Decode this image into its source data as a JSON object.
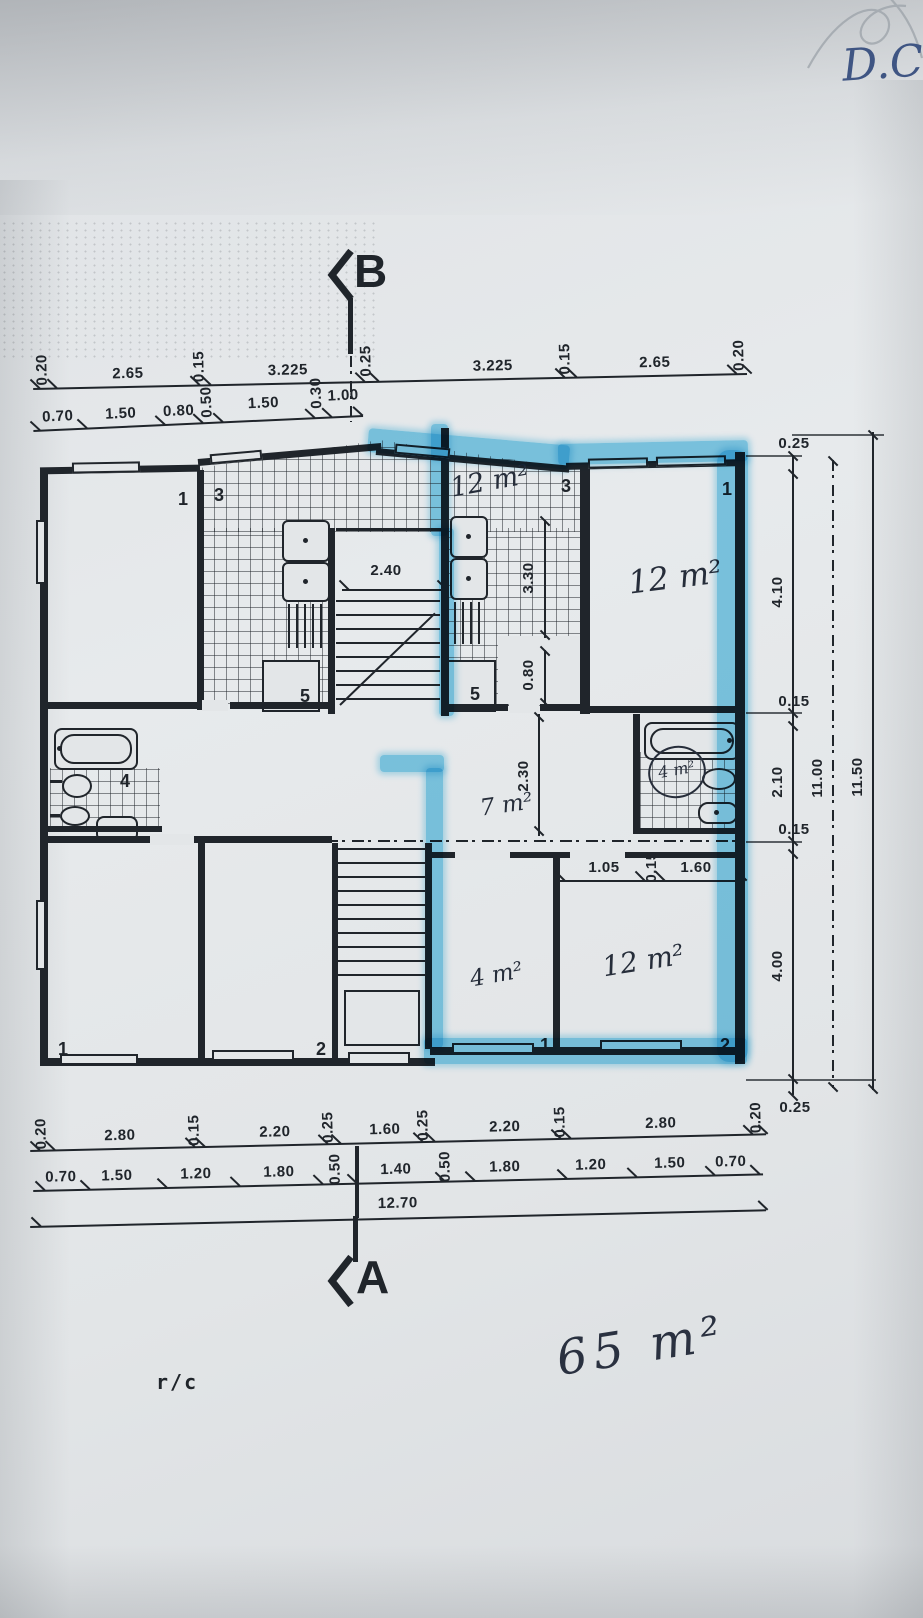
{
  "page": {
    "bg": "#e3e6e8",
    "ink": "#20252b",
    "highlight": "#56c0e8",
    "pen_blue": "#3f5583"
  },
  "header": {
    "handwriting": "D.C"
  },
  "section_markers": {
    "top": "B",
    "bottom": "A"
  },
  "dims": {
    "top_row1": [
      "0.20",
      "2.65",
      "0.15",
      "3.225",
      "0.25",
      "3.225",
      "0.15",
      "2.65",
      "0.20"
    ],
    "top_row2": [
      "0.70",
      "1.50",
      "0.80",
      "0.50",
      "1.50",
      "0.30",
      "1.00"
    ],
    "right_chain": [
      "0.25",
      "4.10",
      "0.15",
      "2.10",
      "0.15",
      "4.00",
      "0.25"
    ],
    "right_total": "11.00",
    "right_overall": "11.50",
    "bottom_row1": [
      "0.20",
      "2.80",
      "0.15",
      "2.20",
      "0.25",
      "1.60",
      "0.25",
      "2.20",
      "0.15",
      "2.80",
      "0.20"
    ],
    "bottom_row2": [
      "0.70",
      "1.50",
      "1.20",
      "1.80",
      "0.50",
      "1.40",
      "0.50",
      "1.80",
      "1.20",
      "1.50",
      "0.70"
    ],
    "bottom_total": "12.70",
    "interior": {
      "stair_width": "2.40",
      "kitchen_depth": "3.30",
      "door": "0.80",
      "hall_depth": "2.30",
      "seg_105": "1.05",
      "seg_015": "0.15",
      "seg_160": "1.60"
    }
  },
  "rooms": {
    "numbers": {
      "top_left": "1",
      "kitchen_left": "3",
      "kitchen_right": "3",
      "top_right": "1",
      "store_left": "5",
      "store_right": "5",
      "bath_left": "4",
      "bottom_left_1": "1",
      "bottom_left_2": "2",
      "bottom_right_1": "1",
      "bottom_right_2": "2"
    },
    "areas": {
      "kitchen_top": "12 m²",
      "bedroom_top_right": "12 m²",
      "hall": "7 m²",
      "bath_right": "4 m²",
      "room_bottom_center": "4 m²",
      "bedroom_bottom_right": "12 m²"
    }
  },
  "footer": {
    "floor_label": "r/c",
    "total_area": "65 m²"
  }
}
